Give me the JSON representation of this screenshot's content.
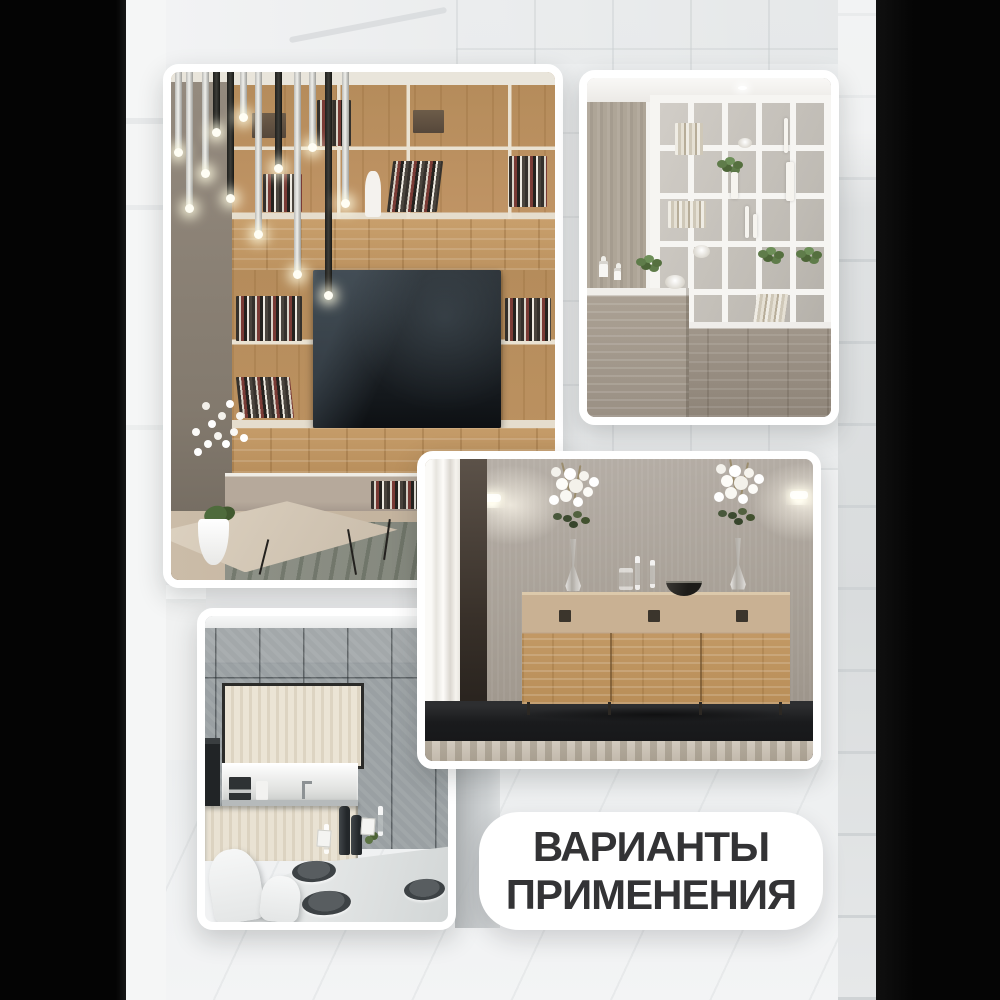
{
  "caption": {
    "line1": "ВАРИАНТЫ",
    "line2": "ПРИМЕНЕНИЯ"
  },
  "photos": [
    {
      "id": "living-room-wall-unit",
      "description": "Living room with oak shelving wall unit, TV, pendant lights, coffee table and white orchid"
    },
    {
      "id": "white-shelf-divider",
      "description": "White open-shelf room divider with plants and decor above grey wood cabinets"
    },
    {
      "id": "oak-sideboard",
      "description": "Oak three-door sideboard with white rose bouquets, glasses and wall sconces"
    },
    {
      "id": "grey-kitchen",
      "description": "Grey concrete-panel kitchen with cream cabinet niche and set dining table"
    }
  ],
  "colors": {
    "caption_bg": "#ffffff",
    "caption_text": "#333335",
    "card_frame": "#ffffff",
    "backdrop": "#f1f2f3",
    "backdrop_dark_columns": "#050505",
    "oak_wood": "#bb9261",
    "concrete_grey": "#9aa0a3"
  }
}
